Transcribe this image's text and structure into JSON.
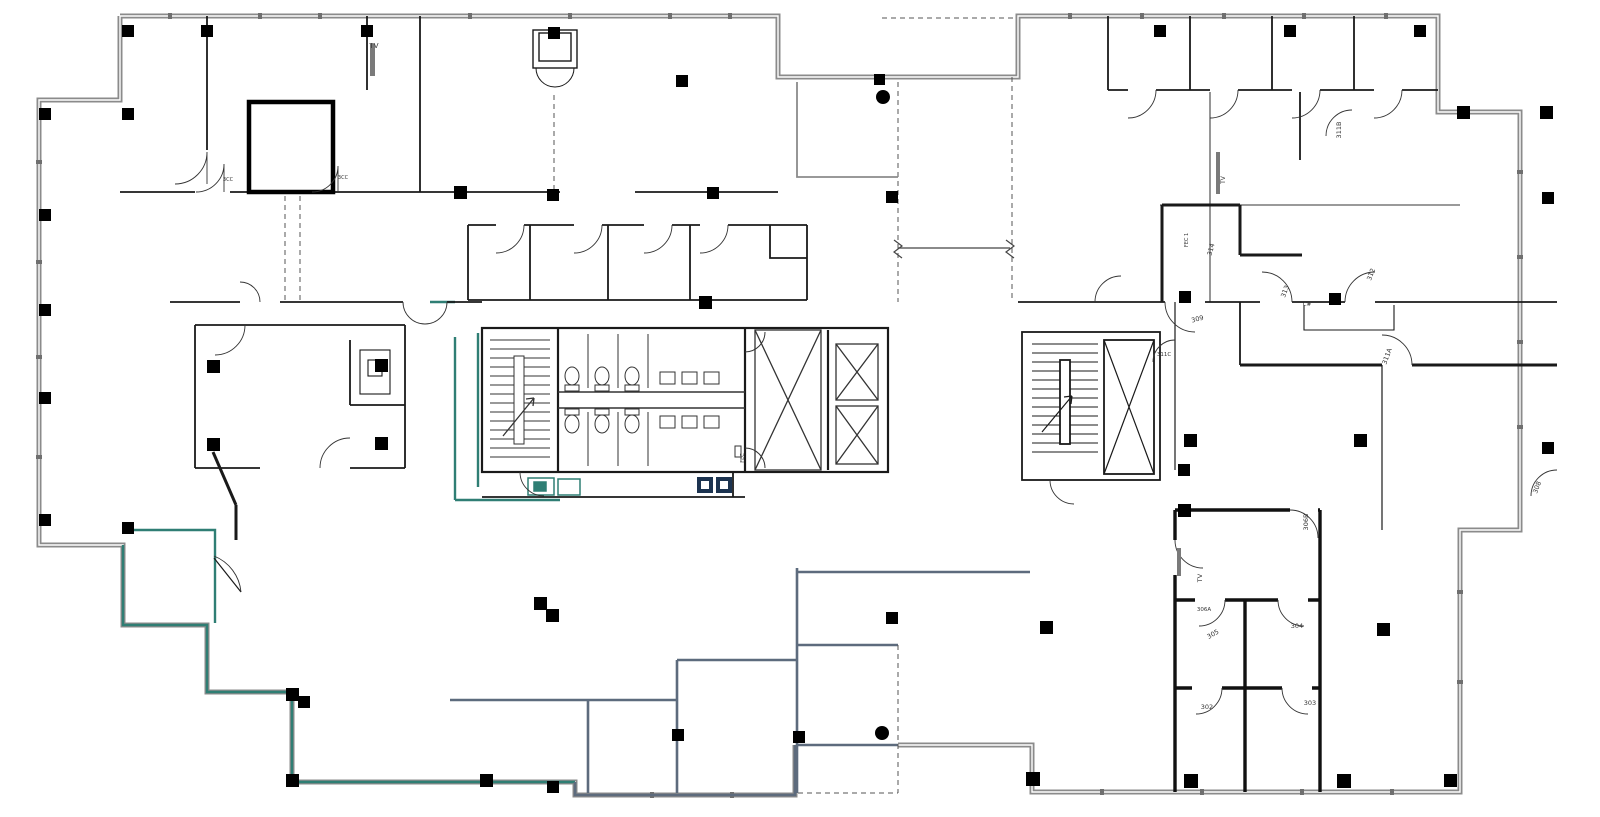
{
  "plan": {
    "kind": "architectural floor plan",
    "background": "#ffffff",
    "colors": {
      "perimeter_wall": "#8b8b8b",
      "interior_wall": "#1a1a1a",
      "teal_accent": "#2f7e74",
      "slate_accent": "#5d6b7d",
      "navy_accent": "#1c3350",
      "label_text": "#333333"
    },
    "rooms": [
      "302",
      "303",
      "304",
      "305",
      "306A",
      "306B",
      "308",
      "309",
      "311A",
      "311B",
      "311C",
      "312",
      "313",
      "314"
    ],
    "annotations": [
      "TV",
      "FEC",
      "FEC 1",
      "C#",
      "3CC"
    ],
    "symbols": {
      "column": "filled black square",
      "door": "quarter-circle swing arc",
      "elevator": "rectangle with X",
      "stair": "parallel treads with direction arrow",
      "toilet": "ellipse with tank",
      "sink": "small square",
      "tv": "wall-mounted gray rectangle",
      "drain": "filled black circle"
    },
    "labels": [
      {
        "id": "tv-top-left",
        "text": "TV"
      },
      {
        "id": "door-tag-1",
        "text": "3CC"
      },
      {
        "id": "door-tag-2",
        "text": "3CC"
      },
      {
        "id": "fec-core",
        "text": "FEC"
      },
      {
        "id": "tv-right-wing",
        "text": "TV"
      },
      {
        "id": "fec-1",
        "text": "FEC 1"
      },
      {
        "id": "room-311B",
        "text": "311B"
      },
      {
        "id": "room-314",
        "text": "314"
      },
      {
        "id": "room-313",
        "text": "313"
      },
      {
        "id": "casework-ch",
        "text": "C#"
      },
      {
        "id": "room-312",
        "text": "312"
      },
      {
        "id": "room-309",
        "text": "309"
      },
      {
        "id": "room-311C",
        "text": "311C"
      },
      {
        "id": "room-311A",
        "text": "311A"
      },
      {
        "id": "room-308",
        "text": "308"
      },
      {
        "id": "room-306B",
        "text": "306B"
      },
      {
        "id": "tv-306",
        "text": "TV"
      },
      {
        "id": "room-306A",
        "text": "306A"
      },
      {
        "id": "room-305",
        "text": "305"
      },
      {
        "id": "room-304",
        "text": "304"
      },
      {
        "id": "room-302",
        "text": "302"
      },
      {
        "id": "room-303",
        "text": "303"
      }
    ]
  }
}
